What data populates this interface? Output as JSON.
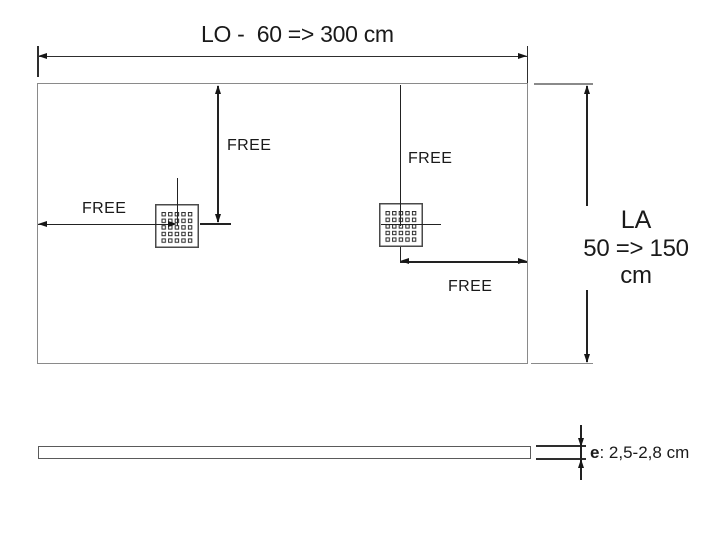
{
  "top_view": {
    "length_label": "LO -  60 => 300 cm",
    "width_label": [
      "LA",
      "50 => 150 cm"
    ],
    "free_labels": [
      "FREE",
      "FREE",
      "FREE",
      "FREE"
    ]
  },
  "side_view": {
    "thickness_symbol": "e",
    "thickness_range": ": 2,5-2,8 cm"
  },
  "colors": {
    "outline_gray": "#8a8a8a",
    "dimension_line": "#2e2e2e",
    "arrowhead": "#161616",
    "text": "#1a1a1a",
    "background": "#ffffff"
  }
}
